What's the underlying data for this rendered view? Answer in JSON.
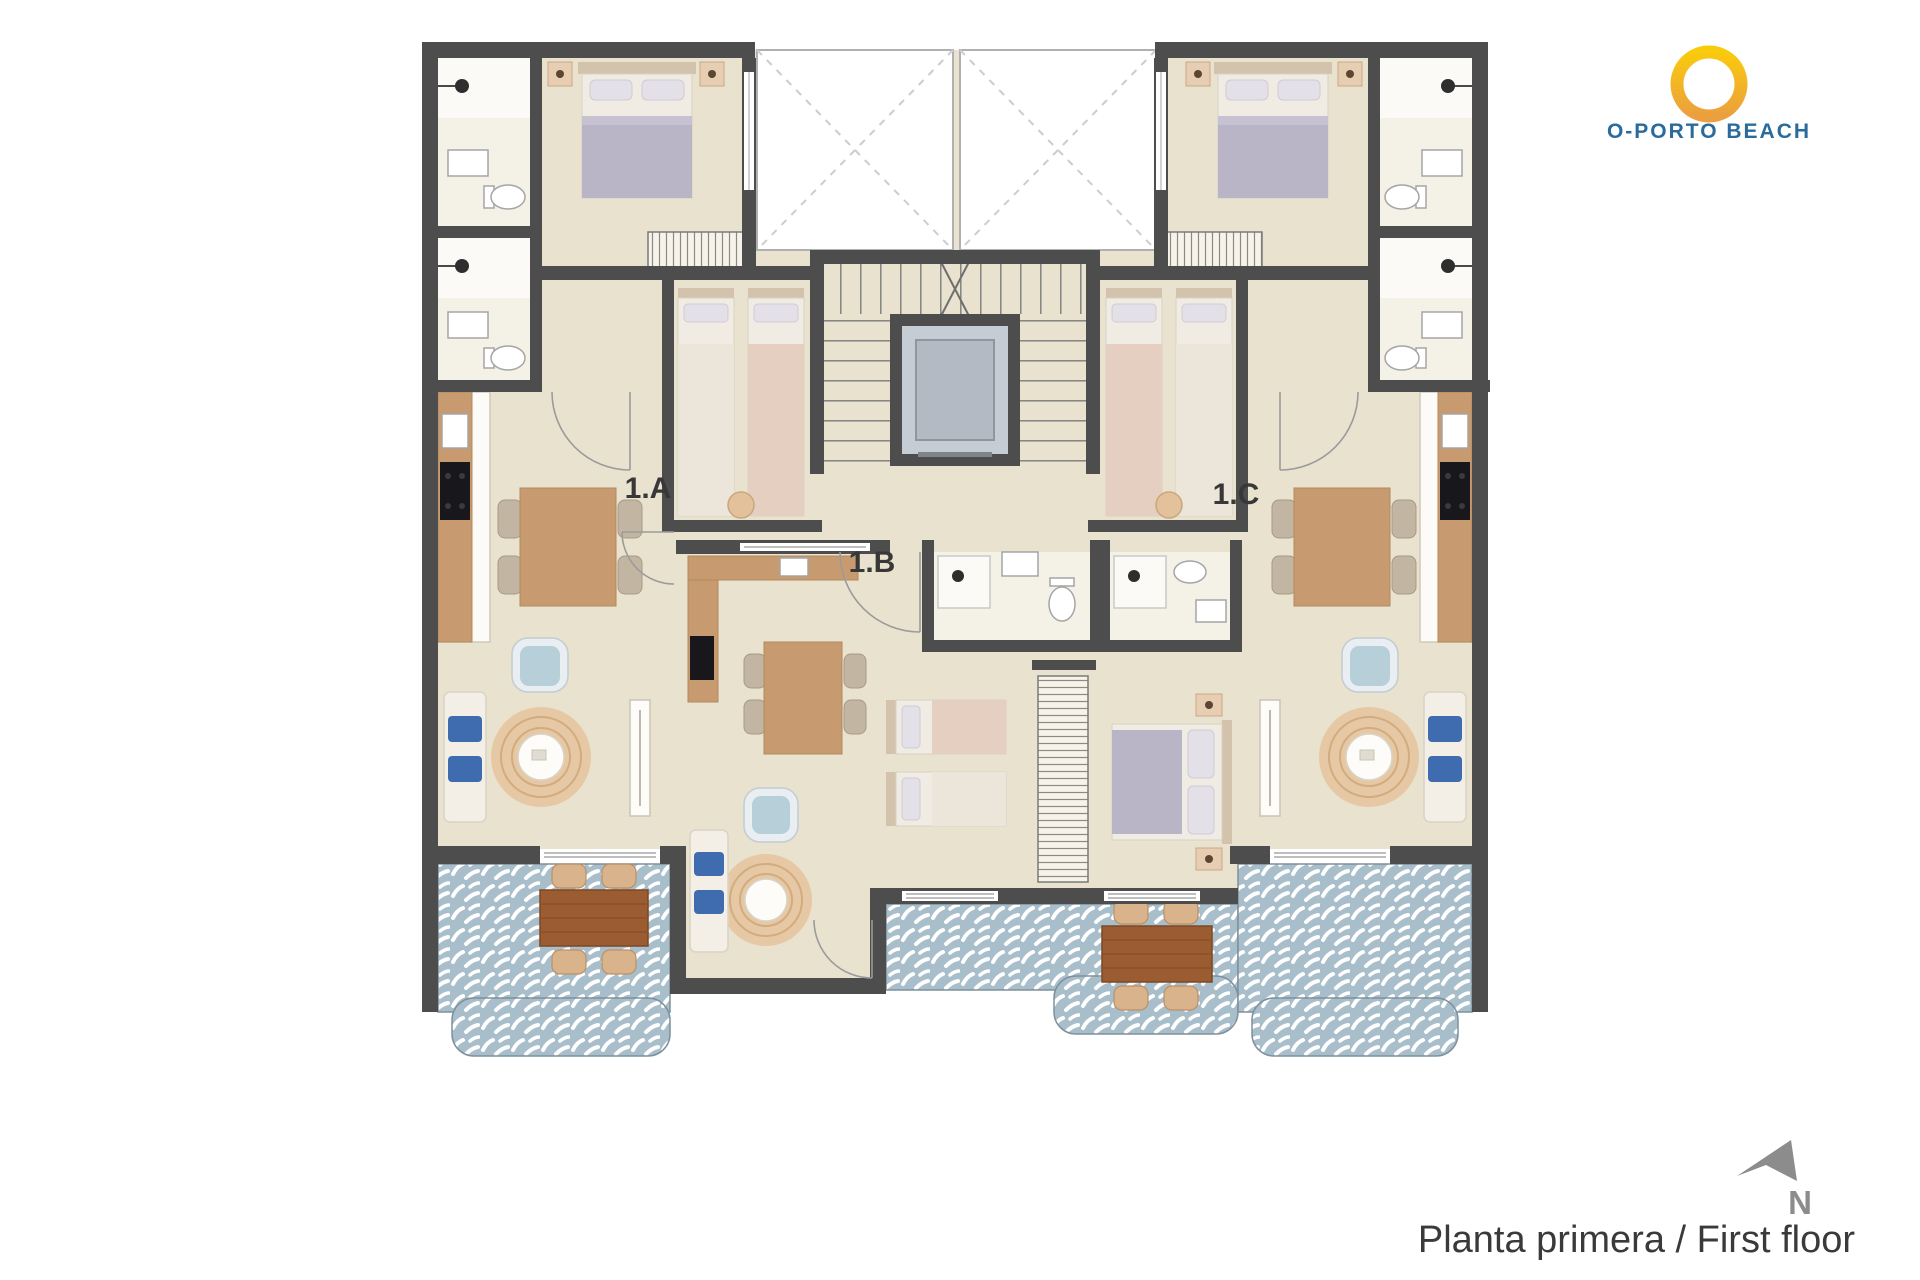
{
  "page": {
    "background": "#ffffff",
    "caption": "Planta primera / First floor"
  },
  "logo": {
    "title": "O-PORTO BEACH"
  },
  "compass": {
    "label": "N"
  },
  "apartments": [
    {
      "label": "1.A"
    },
    {
      "label": "1.B"
    },
    {
      "label": "1.C"
    }
  ],
  "colors": {
    "wall": "#4d4d4d",
    "floor": "#e9e2cf",
    "bath_floor": "#f4f1e7",
    "terrace_tile_base": "#a9becb",
    "terrace_tile_motif": "#ffffff",
    "kitchen_wood": "#c79b6f",
    "outdoor_table_wood": "#9a5c30",
    "wicker_chair": "#d9b38c",
    "bed_blanket": "#b9b4c6",
    "bed_linen": "#f1ece3",
    "sofa_pillow_blue": "#3f6cae",
    "armchair_blue": "#b7cfd9",
    "rug_jute": "#e6c9a4",
    "elevator_cab": "#c6ccd3",
    "logo_ring_top": "#f9cb0d",
    "logo_ring_bottom": "#ec9f3e",
    "logo_text": "#2a6b9e",
    "annotation_text": "#3a3a3a",
    "compass_gray": "#8c8c8c"
  }
}
